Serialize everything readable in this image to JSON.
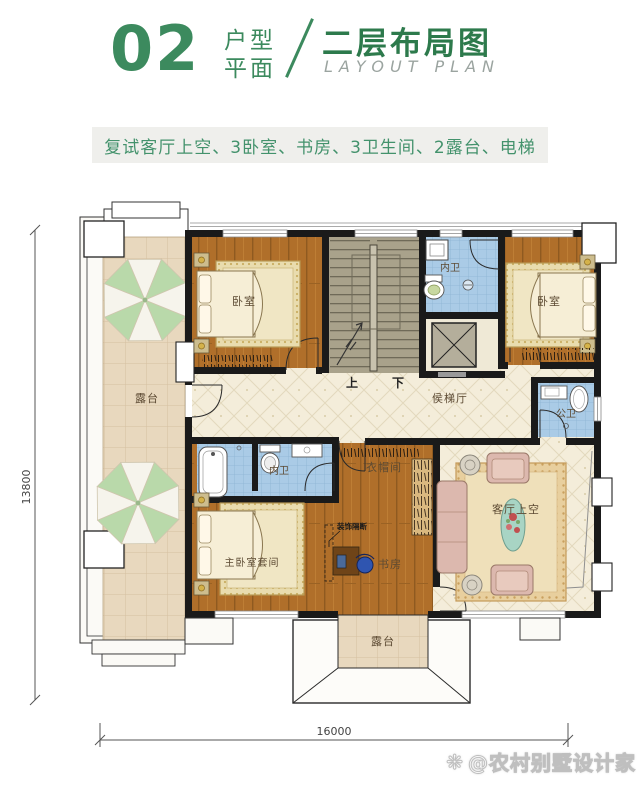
{
  "header": {
    "number": "02",
    "unit_line1": "户型",
    "unit_line2": "平面",
    "title_cn": "二层布局图",
    "title_en": "LAYOUT PLAN"
  },
  "features": "复试客厅上空、3卧室、书房、3卫生间、2露台、电梯",
  "plan": {
    "dims": {
      "left": "13800",
      "bottom": "16000"
    },
    "labels": {
      "terrace_left": "露台",
      "terrace_bottom": "露台",
      "bedroom_tl": "卧室",
      "bedroom_tr": "卧室",
      "bath_top": "内卫",
      "bath_mid": "内卫",
      "bath_public": "公卫",
      "lift_hall": "侯梯厅",
      "stair_up": "上",
      "stair_down": "下",
      "cloakroom": "衣帽间",
      "master_suite": "主卧室套间",
      "study": "书房",
      "living_void": "客厅上空",
      "partition_note": "装饰隔断"
    }
  },
  "watermark": {
    "icon": "❋",
    "text": "@农村别墅设计家"
  },
  "colors": {
    "accent_green": "#2d7a4c",
    "light_green": "#3c8a5e",
    "bar_bg": "#efefec",
    "bar_text": "#43926c",
    "wall": "#1a1a1a",
    "wood": "#b06f2a",
    "tile_blue": "#aacbe6",
    "tile_cream": "#f4edda",
    "terrace_tan": "#e8d8be",
    "stairs_olive": "#a9a28b"
  }
}
